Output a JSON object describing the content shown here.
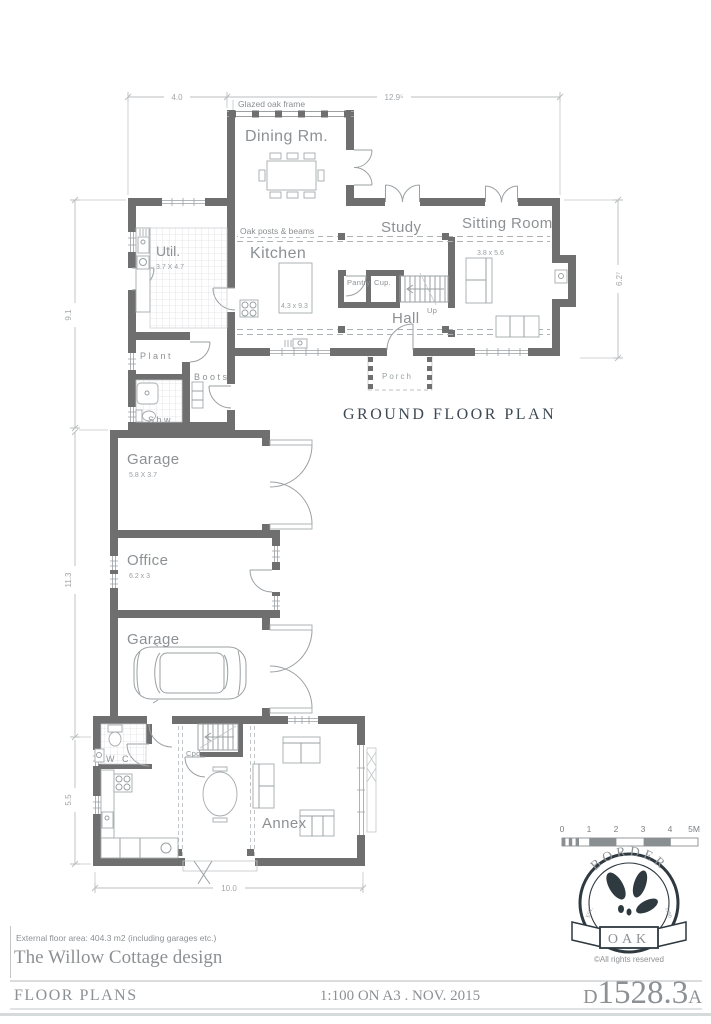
{
  "sheet": {
    "plan_title": "GROUND FLOOR PLAN",
    "area_note": "External floor area: 404.3 m2 (including garages etc.)",
    "design_title": "The Willow Cottage design",
    "footer_left": "FLOOR PLANS",
    "footer_center": "1:100 ON A3 . NOV. 2015",
    "drawing_prefix": "D",
    "drawing_number": "1528.3",
    "drawing_suffix": "A"
  },
  "rooms": {
    "dining": "Dining Rm.",
    "kitchen": "Kitchen",
    "kitchen_size": "4.3 x 9.3",
    "util": "Util.",
    "util_size": "3.7 X 4.7",
    "study": "Study",
    "sitting": "Sitting Room",
    "sitting_size": "3.8 x 5.6",
    "hall": "Hall",
    "pantry": "Pantry",
    "cupboard": "Cup.",
    "stairs_up": "Up",
    "plant": "Plant",
    "boots": "Boots",
    "shower": "Shw.",
    "porch": "Porch",
    "garage_top": "Garage",
    "garage_top_size": "5.8 X 3.7",
    "office": "Office",
    "office_size": "6.2 x 3",
    "garage_bottom": "Garage",
    "annex": "Annex",
    "wc": "W C",
    "cupboard_annex": "Cpd."
  },
  "annotations": {
    "glazed_oak_frame": "Glazed oak frame",
    "oak_posts_beams": "Oak posts & beams"
  },
  "dimensions": {
    "top_left": "4.0",
    "top_right": "12.9⁵",
    "side_right": "6.2⁷",
    "left_upper": "9.1",
    "left_middle": "11.3",
    "left_lower": "5.5",
    "bottom": "10.0"
  },
  "scale_bar": {
    "labels": [
      "0",
      "1",
      "2",
      "3",
      "4",
      "5M"
    ]
  },
  "logo": {
    "arc_text": "BORDER",
    "banner_text": "OAK",
    "est": "EST.",
    "year": "1980",
    "copyright": "©All rights reserved"
  },
  "colors": {
    "wall": "#6f6f6f",
    "ink": "#3e4a54",
    "label": "#8d9194",
    "dimline": "#b9bdbf"
  }
}
